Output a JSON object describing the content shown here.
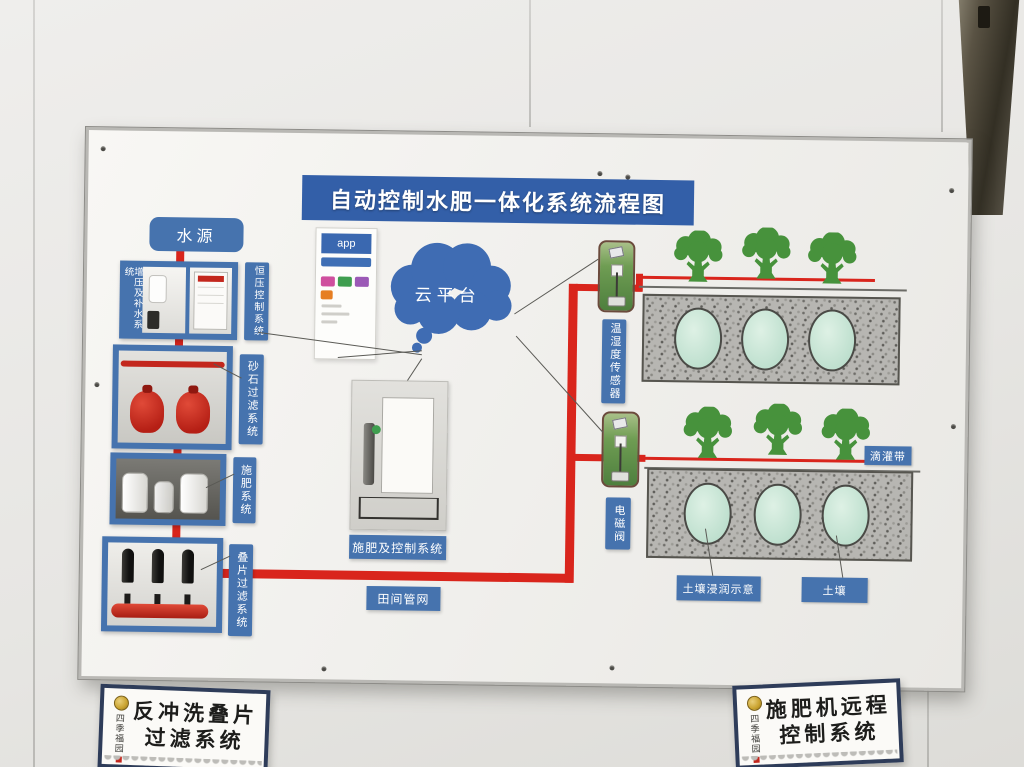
{
  "board": {
    "title": "自动控制水肥一体化系统流程图",
    "water_source_label": "水源",
    "boost_system_label": "增压及补水系统",
    "constant_pressure_label": "恒压控制系统",
    "sand_filter_label": "砂石过滤系统",
    "fertilizer_system_label": "施肥系统",
    "disc_filter_label": "叠片过滤系统",
    "app_label": "app",
    "cloud_label": "云平台",
    "machine_label": "施肥及控制系统",
    "field_network_label": "田间管网",
    "sensor_label": "温湿度传感器",
    "valve_label": "电磁阀",
    "drip_tape_label": "滴灌带",
    "soil_wetting_label": "土壤浸润示意",
    "soil_label": "土壤"
  },
  "signs": {
    "left": {
      "seal_text": "四季福园",
      "line1": "反冲洗叠片",
      "line2": "过滤系统"
    },
    "right": {
      "seal_text": "四季福园",
      "line1": "施肥机远程",
      "line2": "控制系统"
    }
  },
  "colors": {
    "banner_blue": "#335fa8",
    "label_blue": "#4673ae",
    "pipe_red": "#d9251c",
    "tree_green": "#47923c",
    "wet_zone_teal": "#cde8da",
    "soil_grey": "#b7b6b2",
    "seal_gold": "#c9a22e"
  }
}
